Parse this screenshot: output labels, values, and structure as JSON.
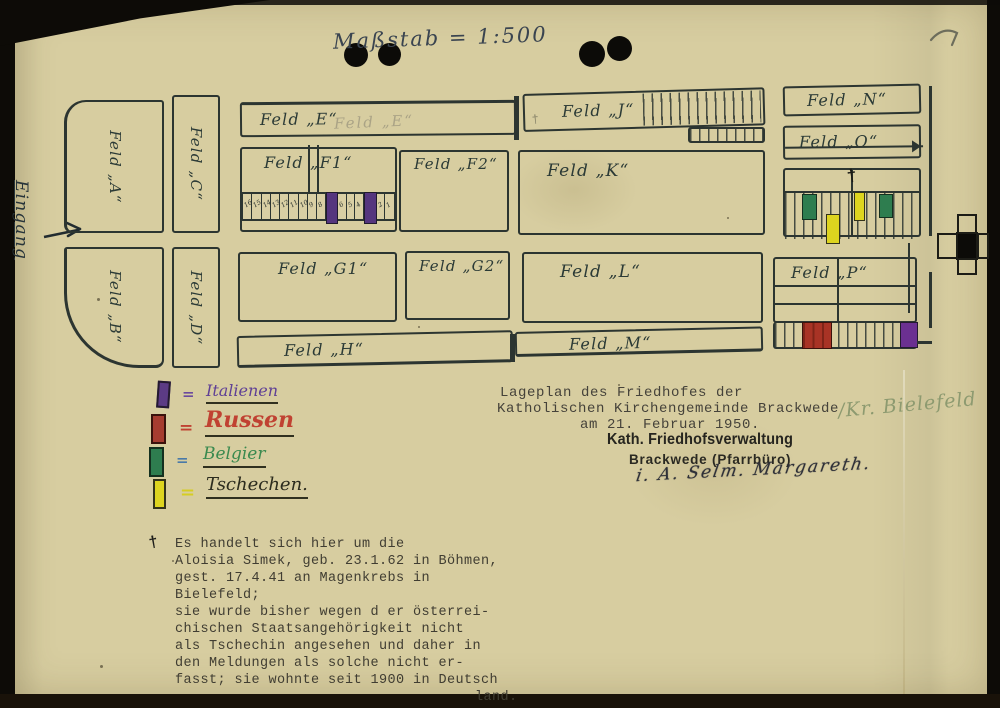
{
  "scale": {
    "label": "Maßstab = 1:500"
  },
  "entrance": {
    "label": "Eingang"
  },
  "map": {
    "fields": {
      "a": "Feld „A“",
      "b": "Feld „B“",
      "c": "Feld „C“",
      "d": "Feld „D“",
      "e": "Feld „E“",
      "e_ghost": "Feld „E“",
      "f1": "Feld „F1“",
      "f2": "Feld „F2“",
      "g1": "Feld „G1“",
      "g2": "Feld „G2“",
      "h": "Feld „H“",
      "j": "Feld „J“",
      "k": "Feld „K“",
      "l": "Feld „L“",
      "m": "Feld „M“",
      "n": "Feld „N“",
      "o": "Feld „O“",
      "p": "Feld „P“"
    },
    "f1_cells": [
      "16",
      "15",
      "14",
      "13",
      "12",
      "11",
      "10",
      "9",
      "8",
      "",
      "6",
      "5",
      "4",
      "",
      "2",
      "1"
    ],
    "grave_cross_mark": "†",
    "faint_cross_mark": "†"
  },
  "legend": {
    "items": [
      {
        "eq": "=",
        "label": "Italienen",
        "color": "#5c3b85"
      },
      {
        "eq": "=",
        "label": "Russen",
        "color": "#b13a2b"
      },
      {
        "eq": "=",
        "label": "Belgier",
        "color": "#2e7d4f"
      },
      {
        "eq": "=",
        "label": "Tschechen.",
        "color": "#ddd41f"
      }
    ]
  },
  "title_block": {
    "line1": "Lageplan des Friedhofes der",
    "line2": "Katholischen Kirchengemeinde Brackwede",
    "line3": "am 21. Februar 1950.",
    "annotation": "/Kr. Bielefeld",
    "stamp_line1": "Kath. Friedhofsverwaltung",
    "stamp_line2": "Brackwede (Pfarrbüro)",
    "signature": "i. A. Selm. Margareth."
  },
  "footnote": {
    "marker": "†",
    "lines": [
      "Es handelt sich hier um die",
      "Aloisia Simek, geb. 23.1.62 in Böhmen,",
      "gest. 17.4.41 an Magenkrebs in",
      "Bielefeld;",
      "sie wurde bisher wegen d er österrei-",
      "chischen Staatsangehörigkeit nicht",
      "als Tschechin angesehen und daher in",
      "den Meldungen als solche nicht er-",
      "fasst; sie wohnte seit 1900 in Deutsch",
      "land."
    ]
  },
  "colors": {
    "paper": "#d7cda0",
    "ink": "#2c3531",
    "typewriter": "#45423a",
    "italians": "#5c3b85",
    "russians": "#b13a2b",
    "belgians": "#2e7d4f",
    "czechs": "#ddd41f"
  }
}
